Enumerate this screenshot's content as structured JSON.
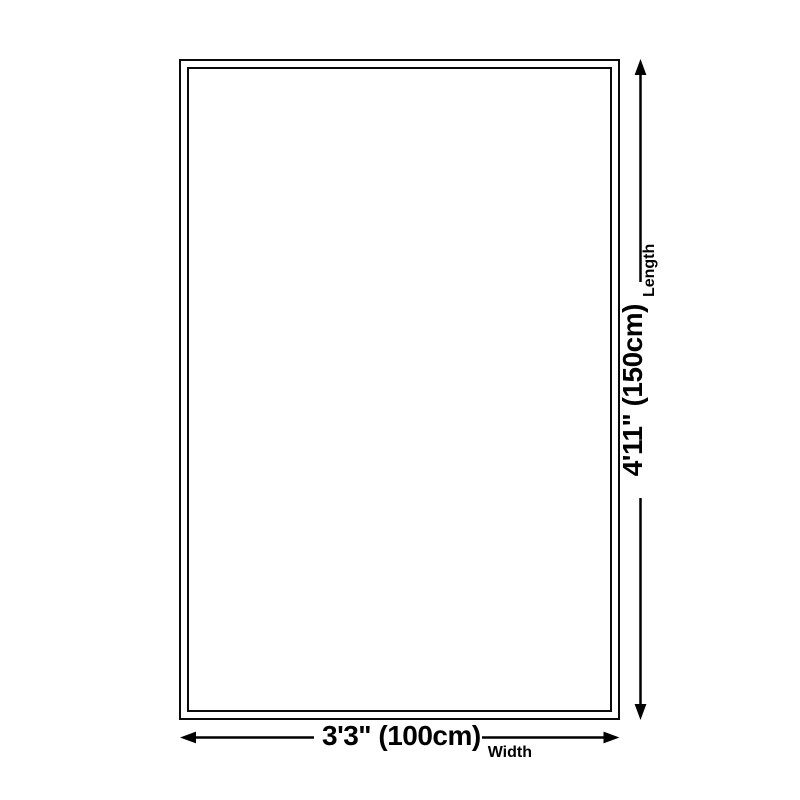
{
  "colors": {
    "ink": "#000000",
    "outline": "#0a0a0a",
    "background": "#ffffff"
  },
  "diagram": {
    "length_dimension": {
      "value": "4'11\" (150cm)",
      "label": "Length"
    },
    "width_dimension": {
      "value": "3'3\" (100cm)",
      "label": "Width"
    }
  }
}
